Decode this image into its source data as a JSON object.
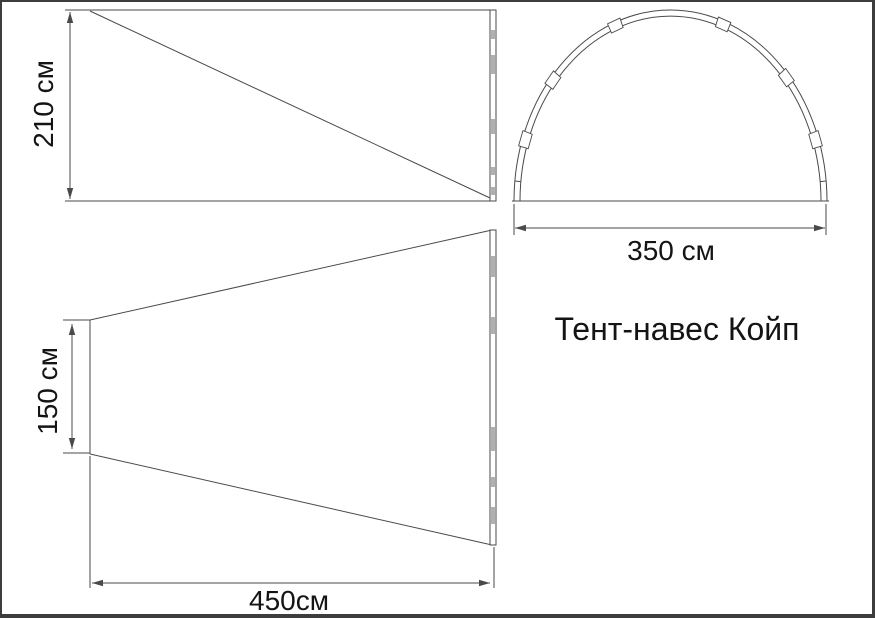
{
  "title": "Тент-навес Койп",
  "diagram": {
    "product": "Тент-навес Койп",
    "type": "tent-awning dimensional drawing, three views",
    "views": [
      "side view (height)",
      "front arch view (width)",
      "top view (footprint)"
    ],
    "dimensions": {
      "height": "210 см",
      "width": "350 см",
      "rear_width": "150 см",
      "depth": "450см"
    }
  },
  "colors": {
    "bg": "#ffffff",
    "frame": "#3d3d3d",
    "line": "#4a4a4a",
    "text": "#141414",
    "joint_fill": "#b0b0b0"
  },
  "layout": {
    "canvas": {
      "w": 875,
      "h": 618,
      "frame_w": "2px 3px 4px 2px"
    },
    "side_view": {
      "lines": [
        [
          63,
          8,
          494,
          8
        ],
        [
          63,
          199,
          494,
          199
        ],
        [
          88,
          9,
          488,
          196
        ]
      ],
      "pole": {
        "x": 488,
        "y": 8,
        "w": 6,
        "h": 191,
        "marks": [
          [
            28,
            9
          ],
          [
            53,
            19
          ],
          [
            117,
            15
          ],
          [
            165,
            8
          ],
          [
            185,
            8
          ]
        ]
      },
      "dims": [
        [
          68,
          10,
          68,
          197
        ]
      ]
    },
    "arch_view": {
      "cx": 668.5,
      "base_y": 199,
      "rx": 156.5,
      "ry": 191,
      "tube": 6,
      "base_line": [
        510,
        199,
        827,
        199
      ],
      "sleeves": [
        19,
        41,
        70,
        111,
        140,
        161
      ],
      "leg_ticks": [
        6,
        174
      ],
      "ext_lines": [
        [
          512,
          202,
          512,
          233
        ],
        [
          824,
          202,
          824,
          233
        ]
      ],
      "dims": [
        [
          513,
          226,
          823,
          226
        ]
      ]
    },
    "top_view": {
      "lines": [
        [
          88,
          318,
          88,
          452
        ],
        [
          88,
          318,
          490,
          228
        ],
        [
          88,
          452,
          490,
          543
        ]
      ],
      "pole": {
        "x": 488,
        "y": 228,
        "w": 6,
        "h": 315,
        "marks": [
          [
            254,
            21
          ],
          [
            315,
            17
          ],
          [
            425,
            24
          ],
          [
            475,
            10
          ],
          [
            505,
            17
          ]
        ]
      },
      "ext_lines": [
        [
          61,
          318,
          88,
          318
        ],
        [
          61,
          451,
          88,
          451
        ],
        [
          88,
          454,
          88,
          586
        ],
        [
          492,
          545,
          492,
          586
        ]
      ],
      "dims": [
        [
          70,
          322,
          70,
          447
        ],
        [
          90,
          581,
          488,
          581
        ]
      ]
    },
    "labels": {
      "height-dimension-label": {
        "x": 42,
        "y": 102,
        "rot": -90,
        "size": 28
      },
      "arch-width-dimension-label": {
        "x": 669,
        "y": 249,
        "rot": 0,
        "size": 28
      },
      "rear-width-dimension-label": {
        "x": 46,
        "y": 389,
        "rot": -90,
        "size": 28
      },
      "depth-dimension-label": {
        "x": 287,
        "y": 599,
        "rot": 0,
        "size": 28
      },
      "product-title": {
        "x": 675,
        "y": 327,
        "rot": 0,
        "size": 32
      }
    }
  }
}
